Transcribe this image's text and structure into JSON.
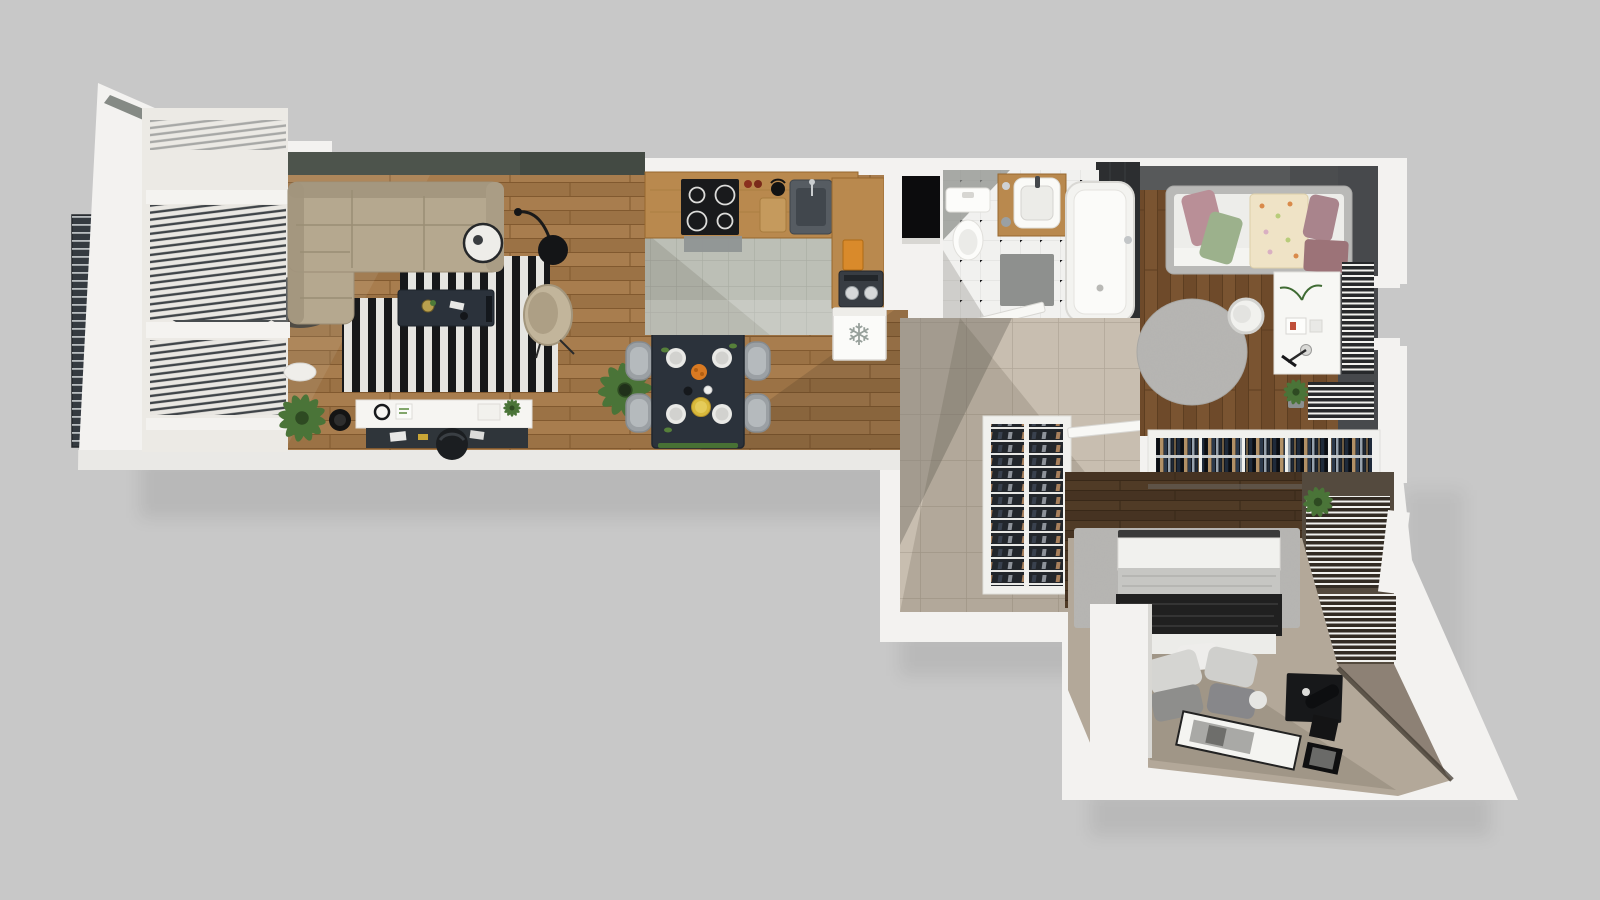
{
  "scene": {
    "label": "3D top-down floor plan render of a one-bedroom apartment with living room, kitchen, dining area, bathroom, hallway and two bedrooms",
    "type": "architectural-render-top-view"
  },
  "palette": {
    "background": "#c8c8c8",
    "wall": "#f3f2f0",
    "olive_wall": "#4d544c",
    "dark_wall": "#47494c",
    "brown_wall": "#544a3e",
    "taupe_wall": "#8d8175",
    "wood_living": "#a87d4e",
    "wood_bedroom": "#7a5431",
    "wood_dark": "#503b26",
    "tile_kitchen": "#bcbfb6",
    "tile_bath": "#f1f1ef",
    "tile_hall": "#c8beb0",
    "floor_bedroom": "#b3a899",
    "sofa_beige": "#b5a88f",
    "rug_black": "#17181a",
    "rug_white": "#e6e5e1",
    "table_navy": "#2b323b",
    "chair_gray": "#9ba0a4",
    "counter_wood": "#b9894e",
    "fridge_white": "#fbfbf9",
    "radiator_dark": "#2e3032",
    "balcony_panel": "#343a40",
    "plant_green": "#4a7438",
    "rug_speckle": "#b7b6b3",
    "bed_black": "#202020",
    "pillow_pink": "#b98f97",
    "pillow_green": "#9cb18c",
    "duvet_cream": "#efe3c6",
    "pillow_mauve": "#a9848c",
    "blanket_rose": "#9c7378"
  },
  "rooms": [
    {
      "name": "living-room",
      "floor": "hardwood",
      "furniture": [
        "corner-sofa",
        "striped-rug",
        "coffee-table",
        "ring-side-table",
        "floor-lamp",
        "egg-chair",
        "media-sideboard",
        "desk-chair",
        "palm-plants",
        "window-blinds",
        "balcony-railing"
      ]
    },
    {
      "name": "dining-area",
      "floor": "hardwood",
      "furniture": [
        "dining-table",
        "four-chairs",
        "table-setting"
      ]
    },
    {
      "name": "kitchen",
      "floor": "ceramic-tile",
      "furniture": [
        "l-shaped-counter",
        "cooktop",
        "range-hood",
        "sink",
        "cutting-board",
        "coffee-machine",
        "fridge"
      ]
    },
    {
      "name": "bathroom",
      "floor": "mosaic-tile",
      "furniture": [
        "bathtub",
        "toilet",
        "vanity-sink",
        "bath-mat",
        "door"
      ]
    },
    {
      "name": "hallway",
      "floor": "stone-tile",
      "furniture": [
        "shoe-cabinet",
        "door"
      ]
    },
    {
      "name": "bedroom-small",
      "floor": "hardwood",
      "furniture": [
        "single-bed",
        "desk",
        "round-chair",
        "round-rug",
        "towel-radiators",
        "wardrobe-rail",
        "plant"
      ]
    },
    {
      "name": "bedroom-master",
      "floor": "laminate",
      "furniture": [
        "double-bed",
        "pillow-pile",
        "area-rug",
        "picture-frames",
        "storage-box",
        "panel-radiators",
        "plant"
      ]
    }
  ],
  "icons": {
    "fridge": {
      "name": "snowflake-icon",
      "glyph": "❄"
    }
  }
}
